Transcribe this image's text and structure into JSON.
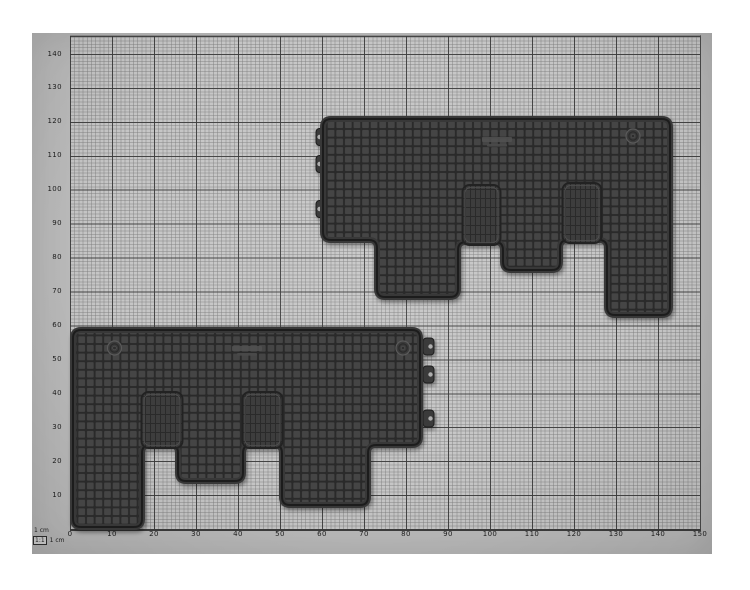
{
  "figure": {
    "description": "Two dark rubber vehicle floor mats photographed on centimetre graph paper",
    "scale_note": "1 cm",
    "scale_ratio": "1:1",
    "scale_unit": "1 cm"
  },
  "axes": {
    "x": {
      "labels": [
        "0",
        "10",
        "20",
        "30",
        "40",
        "50",
        "60",
        "70",
        "80",
        "90",
        "100",
        "110",
        "120",
        "130",
        "140",
        "150"
      ],
      "major_division_cm": 10
    },
    "y": {
      "labels": [
        "140",
        "130",
        "120",
        "110",
        "100",
        "90",
        "80",
        "70",
        "60",
        "50",
        "40",
        "30",
        "20",
        "10"
      ],
      "major_division_cm": 10
    }
  },
  "mats": {
    "upper": {
      "label": "upper mat",
      "span_x_cm": [
        60,
        143
      ],
      "span_y_cm": [
        63,
        121
      ],
      "clip_count": 3,
      "emblem_count": 1,
      "clips_edge": "left"
    },
    "lower": {
      "label": "lower mat",
      "span_x_cm": [
        1,
        84
      ],
      "span_y_cm": [
        0.5,
        58
      ],
      "clip_count": 3,
      "emblem_count": 2,
      "clips_edge": "right"
    }
  },
  "colors": {
    "page_background": "#ffffff",
    "paper_margin": "#bcbcbc",
    "paper_grid_field": "#c6c6c6",
    "grid_major_line": "#3a3a3a",
    "grid_minor_line": "#7d7d7d",
    "mat_base": "#3e3e3e",
    "mat_groove": "#2b2b2b",
    "mat_cell": "#454545",
    "label_text": "#1d1d1d"
  }
}
